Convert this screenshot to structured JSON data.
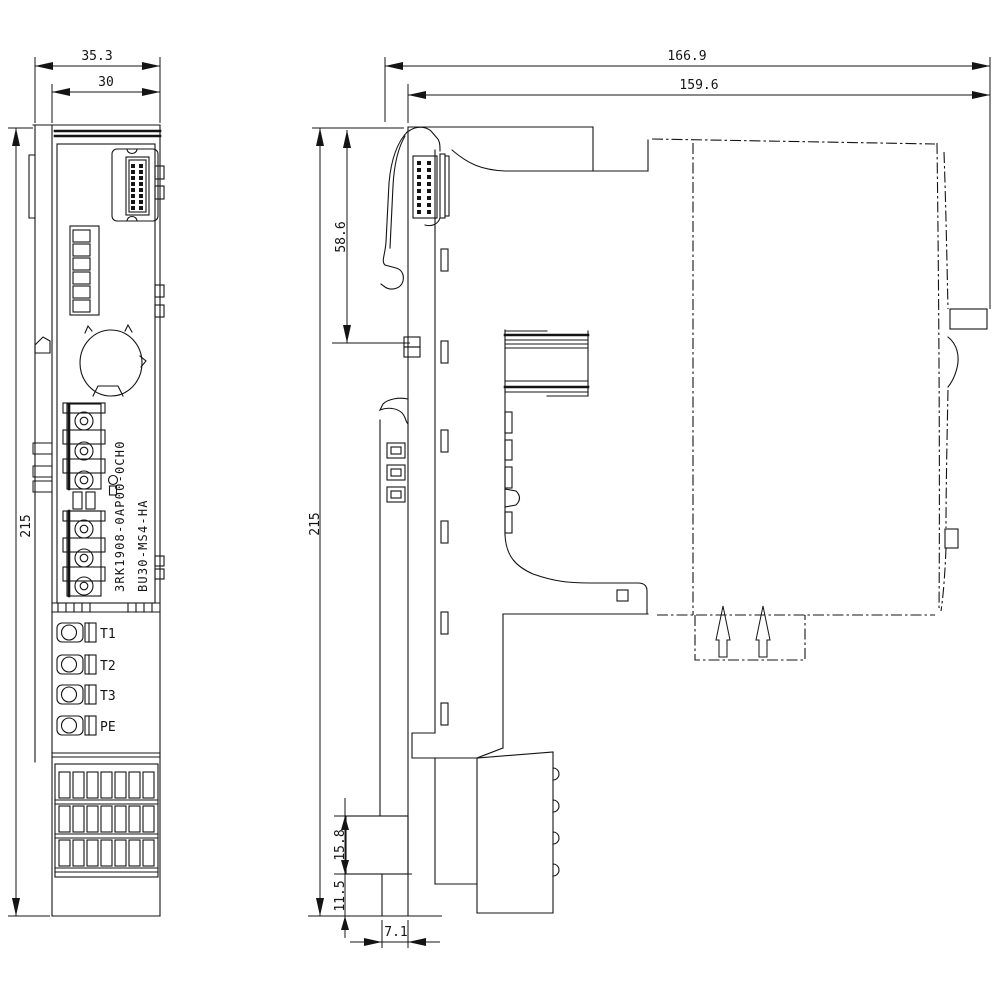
{
  "colors": {
    "background": "#ffffff",
    "line": "#141414"
  },
  "front_view": {
    "dim_overall_width": "35.3",
    "dim_body_width": "30",
    "dim_height": "215",
    "terminals": [
      "T1",
      "T2",
      "T3",
      "PE"
    ],
    "part_number": "3RK1908-0AP00-0CH0",
    "product_code": "BU30-MS4-HA"
  },
  "side_view": {
    "dim_overall_depth": "166.9",
    "dim_mounting_depth": "159.6",
    "dim_height": "215",
    "dim_upper_section_height": "58.6",
    "dim_foot_block_height": "15.8",
    "dim_foot_stem_height": "11.5",
    "dim_foot_stem_width": "7.1"
  }
}
